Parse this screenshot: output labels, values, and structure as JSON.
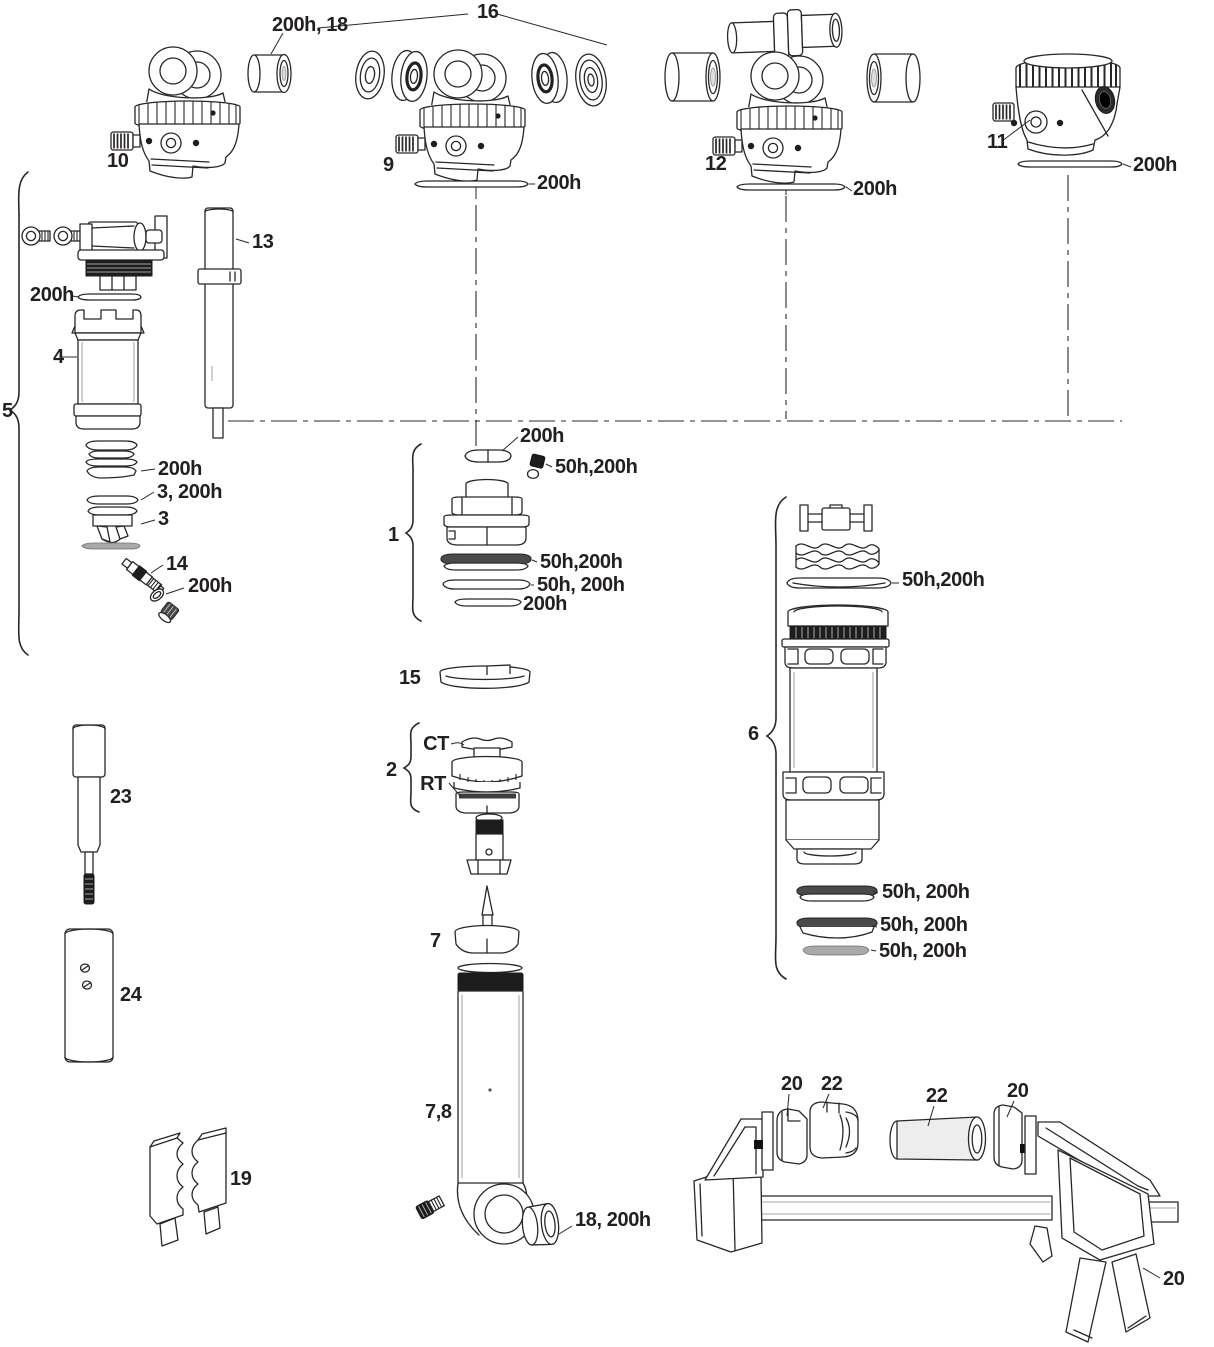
{
  "meta": {
    "background": "#ffffff",
    "ink": "#231f20"
  },
  "labels": {
    "l200h_18": "200h, 18",
    "l16": "16",
    "l10": "10",
    "l9": "9",
    "l9_200h": "200h",
    "l12": "12",
    "l12_200h": "200h",
    "l11": "11",
    "l11_200h": "200h",
    "l13": "13",
    "l5": "5",
    "l4_200h": "200h",
    "l4": "4",
    "lstack_200h": "200h",
    "l3_200h": "3, 200h",
    "l3": "3",
    "l14": "14",
    "l14_200h": "200h",
    "l1": "1",
    "l1_200h_top": "200h",
    "l1_50h200h_screw": "50h,200h",
    "l1_50h200h": "50h,200h",
    "l1_50h_200h": "50h, 200h",
    "l1_200h_bottom": "200h",
    "l15": "15",
    "l2": "2",
    "lct": "CT",
    "lrt": "RT",
    "l7": "7",
    "l78": "7,8",
    "l18_200h": "18, 200h",
    "l6": "6",
    "l6_50h200h": "50h,200h",
    "l6_50h_200h_a": "50h, 200h",
    "l6_50h_200h_b": "50h, 200h",
    "l6_50h_200h_c": "50h, 200h",
    "l23": "23",
    "l24": "24",
    "l19": "19",
    "l20_a": "20",
    "l22_a": "22",
    "l22_b": "22",
    "l20_b": "20",
    "l20_c": "20"
  }
}
